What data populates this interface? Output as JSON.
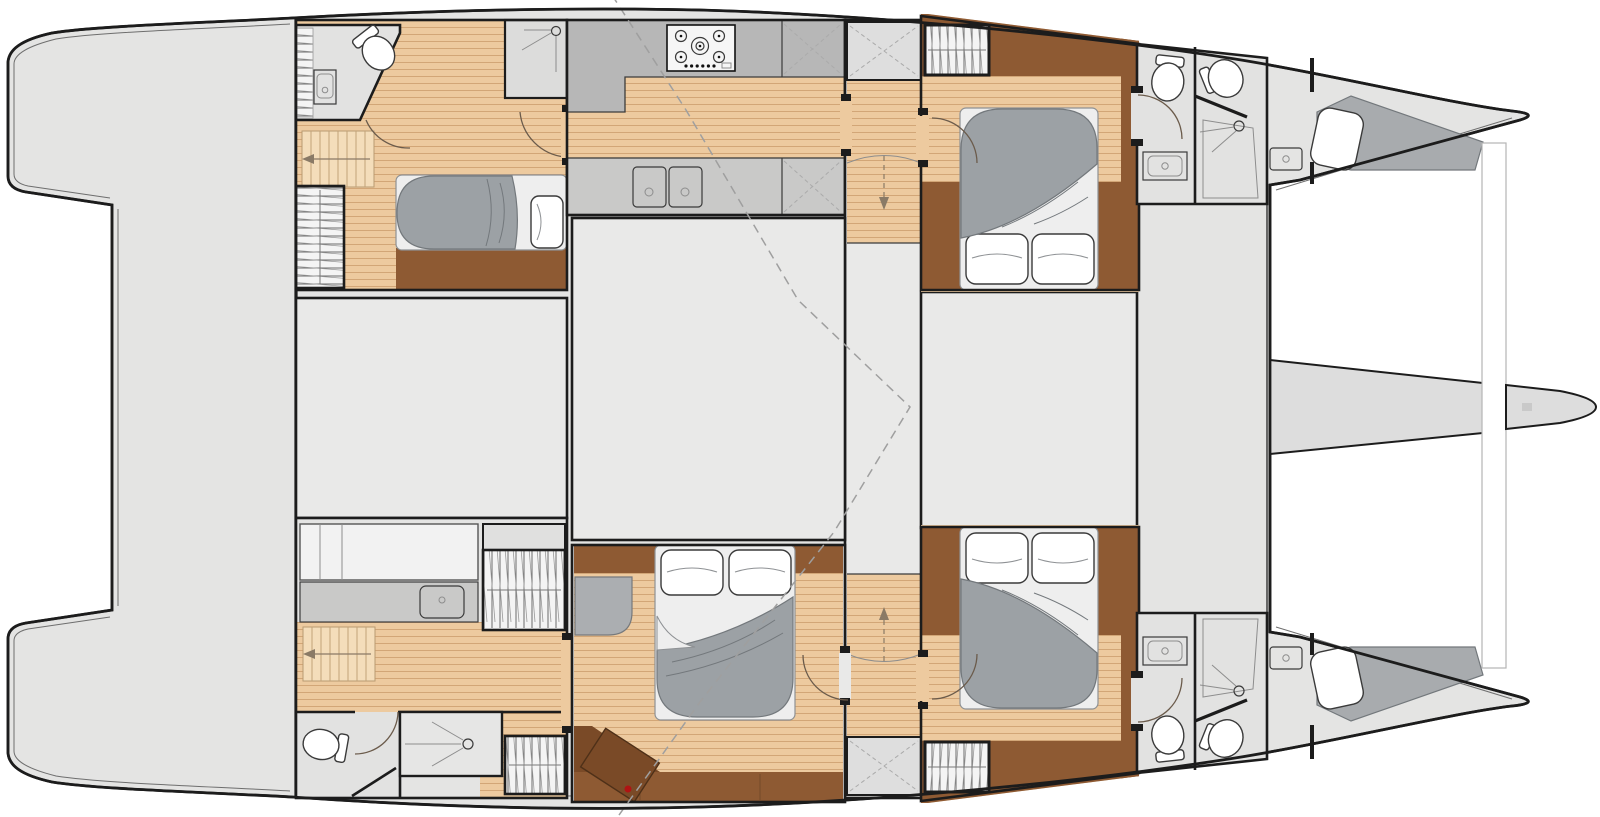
{
  "meta": {
    "type": "yacht-floor-plan",
    "vessel": "sailing-catamaran",
    "view": "overhead-interior-layout",
    "visible_text": []
  },
  "palette": {
    "deck": "#e4e4e3",
    "room": "#e9e9e8",
    "bath": "#e2e2e1",
    "shower": "#dcdcdb",
    "counter": "#b7b7b7",
    "counter2": "#c9c9c8",
    "wood-base": "#edca9f",
    "wood-line": "#d2a677",
    "stair": "#f4ddba",
    "brown": "#8e5a33",
    "brown-dark": "#7a4a27",
    "duvet": "#9ca1a5",
    "duvet-line": "#73787c",
    "linen": "#eeeeee",
    "linen-line": "#8e9194",
    "wall": "#1c1c1c",
    "dash": "#9f9f9f",
    "beam": "#dddddd",
    "red": "#b01313"
  },
  "areas": [
    {
      "id": "aft-platform",
      "label": "aft deck / swim platforms",
      "fixtures": []
    },
    {
      "id": "port-aft-cabin",
      "label": "port aft cabin",
      "fixtures": [
        "double-bed",
        "wardrobe",
        "stairs",
        "shower-cubicle"
      ]
    },
    {
      "id": "port-aft-bathroom",
      "label": "port aft bathroom",
      "fixtures": [
        "toilet",
        "sink"
      ]
    },
    {
      "id": "galley",
      "label": "galley",
      "fixtures": [
        "gas-hob",
        "double-sink",
        "counters",
        "lockers"
      ]
    },
    {
      "id": "saloon",
      "label": "saloon / midship room",
      "fixtures": []
    },
    {
      "id": "companionway",
      "label": "central stair corridor",
      "fixtures": [
        "steps-down",
        "steps-up",
        "lockers"
      ]
    },
    {
      "id": "port-forward-cabin",
      "label": "port forward cabin",
      "fixtures": [
        "double-bed",
        "hanging-locker"
      ]
    },
    {
      "id": "port-forward-bathroom",
      "label": "port forward bathroom",
      "fixtures": [
        "toilet",
        "wc",
        "sink",
        "shower"
      ]
    },
    {
      "id": "port-bow-cabin",
      "label": "port bow compartment",
      "fixtures": [
        "berth",
        "sink"
      ]
    },
    {
      "id": "starboard-aft-quarters",
      "label": "starboard aft quarters",
      "fixtures": [
        "vanity-sink",
        "hanging-lockers",
        "stairs",
        "toilet",
        "shower"
      ]
    },
    {
      "id": "owner-cabin",
      "label": "starboard owner cabin",
      "fixtures": [
        "double-bed",
        "vanity-stool",
        "chart-desk"
      ]
    },
    {
      "id": "starboard-forward-cabin",
      "label": "starboard forward cabin",
      "fixtures": [
        "double-bed",
        "hanging-locker"
      ]
    },
    {
      "id": "starboard-forward-bathroom",
      "label": "starboard forward bathroom",
      "fixtures": [
        "toilet",
        "wc",
        "sink",
        "shower"
      ]
    },
    {
      "id": "starboard-bow-cabin",
      "label": "starboard bow compartment",
      "fixtures": [
        "berth",
        "sink"
      ]
    },
    {
      "id": "foredeck",
      "label": "foredeck",
      "fixtures": []
    },
    {
      "id": "trampoline",
      "label": "trampoline",
      "fixtures": []
    },
    {
      "id": "crossbeam",
      "label": "forward crossbeam",
      "fixtures": []
    },
    {
      "id": "bowsprit",
      "label": "bowsprit",
      "fixtures": []
    }
  ]
}
